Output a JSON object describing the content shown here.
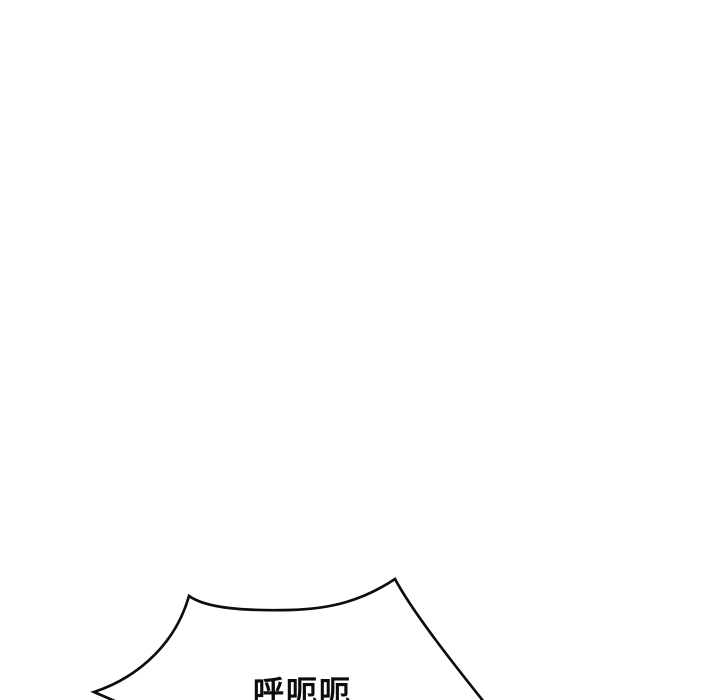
{
  "panel": {
    "background_color": "#ffffff",
    "line_color": "#0d0d0d"
  },
  "speech_bubble": {
    "text": "呼呃呃",
    "text_color": "#0d0d0d",
    "fill_color": "#ffffff",
    "outline_color": "#0d0d0d",
    "shape": "spiky-shout-bubble-top-edge-partially-visible-at-bottom-of-panel"
  }
}
